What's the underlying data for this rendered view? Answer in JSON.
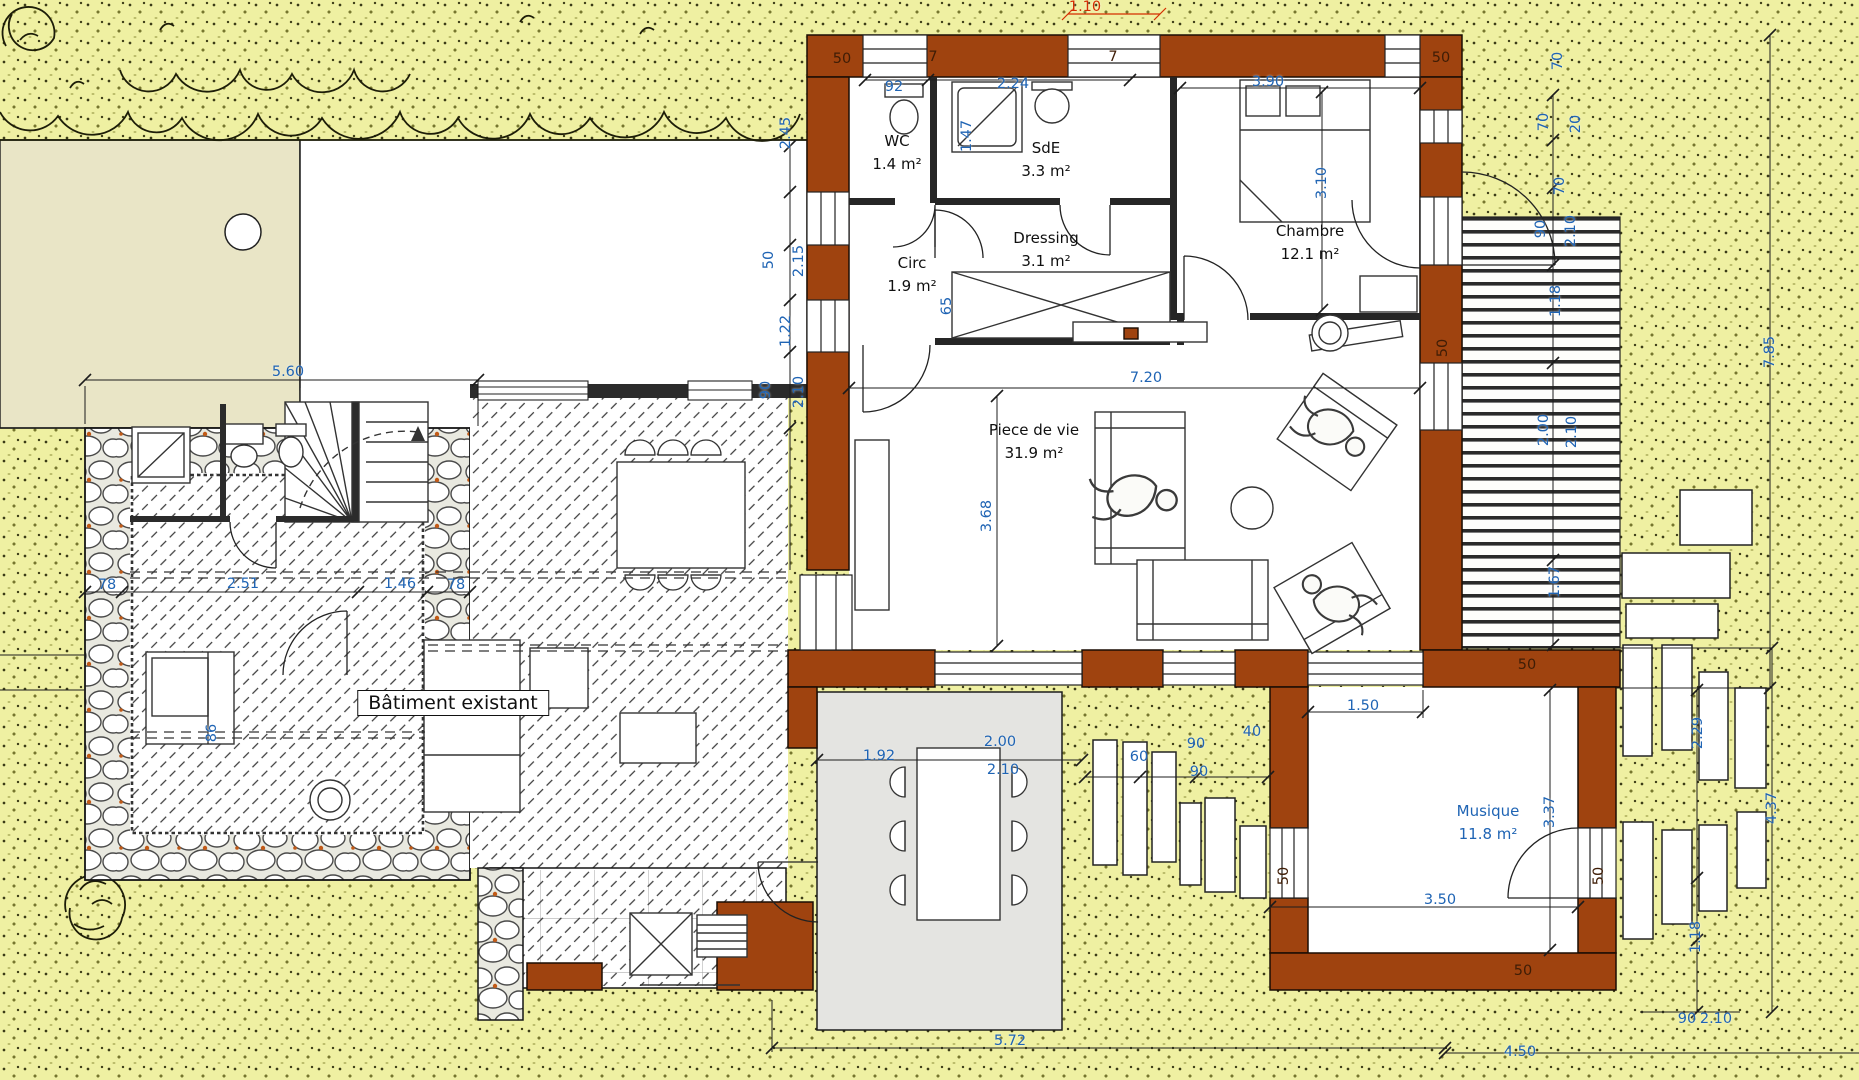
{
  "drawing": {
    "type": "architectural floor plan",
    "colors": {
      "terrain_yellow": "#eff0a2",
      "beige_zone": "#e9e5c6",
      "new_wall_brown": "#9f430f",
      "terrace_gray": "#e4e4e1",
      "dimension_blue": "#1f64b4",
      "dimension_red": "#d42d00",
      "line_black": "#1c1c1c"
    }
  },
  "existing_building": {
    "label": "Bâtiment existant"
  },
  "rooms": [
    {
      "name": "WC",
      "area": "1.4 m²",
      "x": 897,
      "y": 153
    },
    {
      "name": "SdE",
      "area": "3.3 m²",
      "x": 1046,
      "y": 160
    },
    {
      "name": "Dressing",
      "area": "3.1 m²",
      "x": 1046,
      "y": 250
    },
    {
      "name": "Circ",
      "area": "1.9 m²",
      "x": 912,
      "y": 275
    },
    {
      "name": "Chambre",
      "area": "12.1 m²",
      "x": 1310,
      "y": 243
    },
    {
      "name": "Piece de vie",
      "area": "31.9 m²",
      "x": 1034,
      "y": 442
    },
    {
      "name": "Musique",
      "area": "11.8 m²",
      "x": 1488,
      "y": 823,
      "c": "blue"
    }
  ],
  "dims": [
    {
      "t": "5.60",
      "x": 288,
      "y": 372
    },
    {
      "t": "2.45",
      "x": 786,
      "y": 133,
      "r": 1
    },
    {
      "t": "50",
      "x": 769,
      "y": 260,
      "r": 1
    },
    {
      "t": "2.15",
      "x": 799,
      "y": 261,
      "r": 1
    },
    {
      "t": "1.22",
      "x": 786,
      "y": 331,
      "r": 1
    },
    {
      "t": "90",
      "x": 766,
      "y": 390,
      "r": 1
    },
    {
      "t": "2.10",
      "x": 799,
      "y": 392,
      "r": 1
    },
    {
      "t": "50",
      "x": 842,
      "y": 59,
      "c": "dark"
    },
    {
      "t": "7",
      "x": 933,
      "y": 57,
      "c": "dark"
    },
    {
      "t": "92",
      "x": 894,
      "y": 87
    },
    {
      "t": "2.24",
      "x": 1013,
      "y": 84
    },
    {
      "t": "1.47",
      "x": 967,
      "y": 136,
      "r": 1
    },
    {
      "t": "7",
      "x": 1113,
      "y": 57,
      "c": "dark"
    },
    {
      "t": "1.10",
      "x": 1085,
      "y": 7,
      "c": "red"
    },
    {
      "t": "3.90",
      "x": 1268,
      "y": 82
    },
    {
      "t": "50",
      "x": 1441,
      "y": 58,
      "c": "dark"
    },
    {
      "t": "3.10",
      "x": 1322,
      "y": 183,
      "r": 1
    },
    {
      "t": "65",
      "x": 947,
      "y": 306,
      "r": 1
    },
    {
      "t": "7.20",
      "x": 1146,
      "y": 378
    },
    {
      "t": "3.68",
      "x": 987,
      "y": 516,
      "r": 1
    },
    {
      "t": "70",
      "x": 1558,
      "y": 61,
      "r": 1
    },
    {
      "t": "70",
      "x": 1544,
      "y": 122,
      "r": 1
    },
    {
      "t": "20",
      "x": 1576,
      "y": 124,
      "r": 1
    },
    {
      "t": "70",
      "x": 1560,
      "y": 186,
      "r": 1
    },
    {
      "t": "90",
      "x": 1541,
      "y": 229,
      "r": 1
    },
    {
      "t": "2.10",
      "x": 1571,
      "y": 231,
      "r": 1
    },
    {
      "t": "1.18",
      "x": 1556,
      "y": 301,
      "r": 1
    },
    {
      "t": "2.00",
      "x": 1544,
      "y": 430,
      "r": 1
    },
    {
      "t": "2.10",
      "x": 1572,
      "y": 432,
      "r": 1
    },
    {
      "t": "1.67",
      "x": 1555,
      "y": 582,
      "r": 1
    },
    {
      "t": "7.85",
      "x": 1770,
      "y": 352,
      "r": 1
    },
    {
      "t": "50",
      "x": 1443,
      "y": 348,
      "r": 1,
      "c": "dark"
    },
    {
      "t": "50",
      "x": 1527,
      "y": 665,
      "c": "dark"
    },
    {
      "t": "1.50",
      "x": 1363,
      "y": 706
    },
    {
      "t": "2.51",
      "x": 243,
      "y": 584
    },
    {
      "t": "1.46",
      "x": 400,
      "y": 584
    },
    {
      "t": "78",
      "x": 107,
      "y": 585
    },
    {
      "t": "78",
      "x": 456,
      "y": 585
    },
    {
      "t": "86",
      "x": 212,
      "y": 733,
      "r": 1
    },
    {
      "t": "1.92",
      "x": 879,
      "y": 756
    },
    {
      "t": "2.00",
      "x": 1000,
      "y": 742
    },
    {
      "t": "2.10",
      "x": 1003,
      "y": 770
    },
    {
      "t": "60",
      "x": 1139,
      "y": 757
    },
    {
      "t": "90",
      "x": 1196,
      "y": 744
    },
    {
      "t": "90",
      "x": 1199,
      "y": 772
    },
    {
      "t": "40",
      "x": 1252,
      "y": 732
    },
    {
      "t": "3.37",
      "x": 1550,
      "y": 812,
      "r": 1
    },
    {
      "t": "3.50",
      "x": 1440,
      "y": 900
    },
    {
      "t": "50",
      "x": 1284,
      "y": 876,
      "r": 1,
      "c": "dark"
    },
    {
      "t": "50",
      "x": 1599,
      "y": 876,
      "r": 1,
      "c": "dark"
    },
    {
      "t": "50",
      "x": 1523,
      "y": 971,
      "c": "dark"
    },
    {
      "t": "2.29",
      "x": 1698,
      "y": 733,
      "r": 1
    },
    {
      "t": "4.37",
      "x": 1772,
      "y": 808,
      "r": 1
    },
    {
      "t": "1.18",
      "x": 1696,
      "y": 937,
      "r": 1
    },
    {
      "t": "90",
      "x": 1687,
      "y": 1019
    },
    {
      "t": "2.10",
      "x": 1716,
      "y": 1019
    },
    {
      "t": "5.72",
      "x": 1010,
      "y": 1041
    },
    {
      "t": "4.50",
      "x": 1520,
      "y": 1052
    }
  ]
}
